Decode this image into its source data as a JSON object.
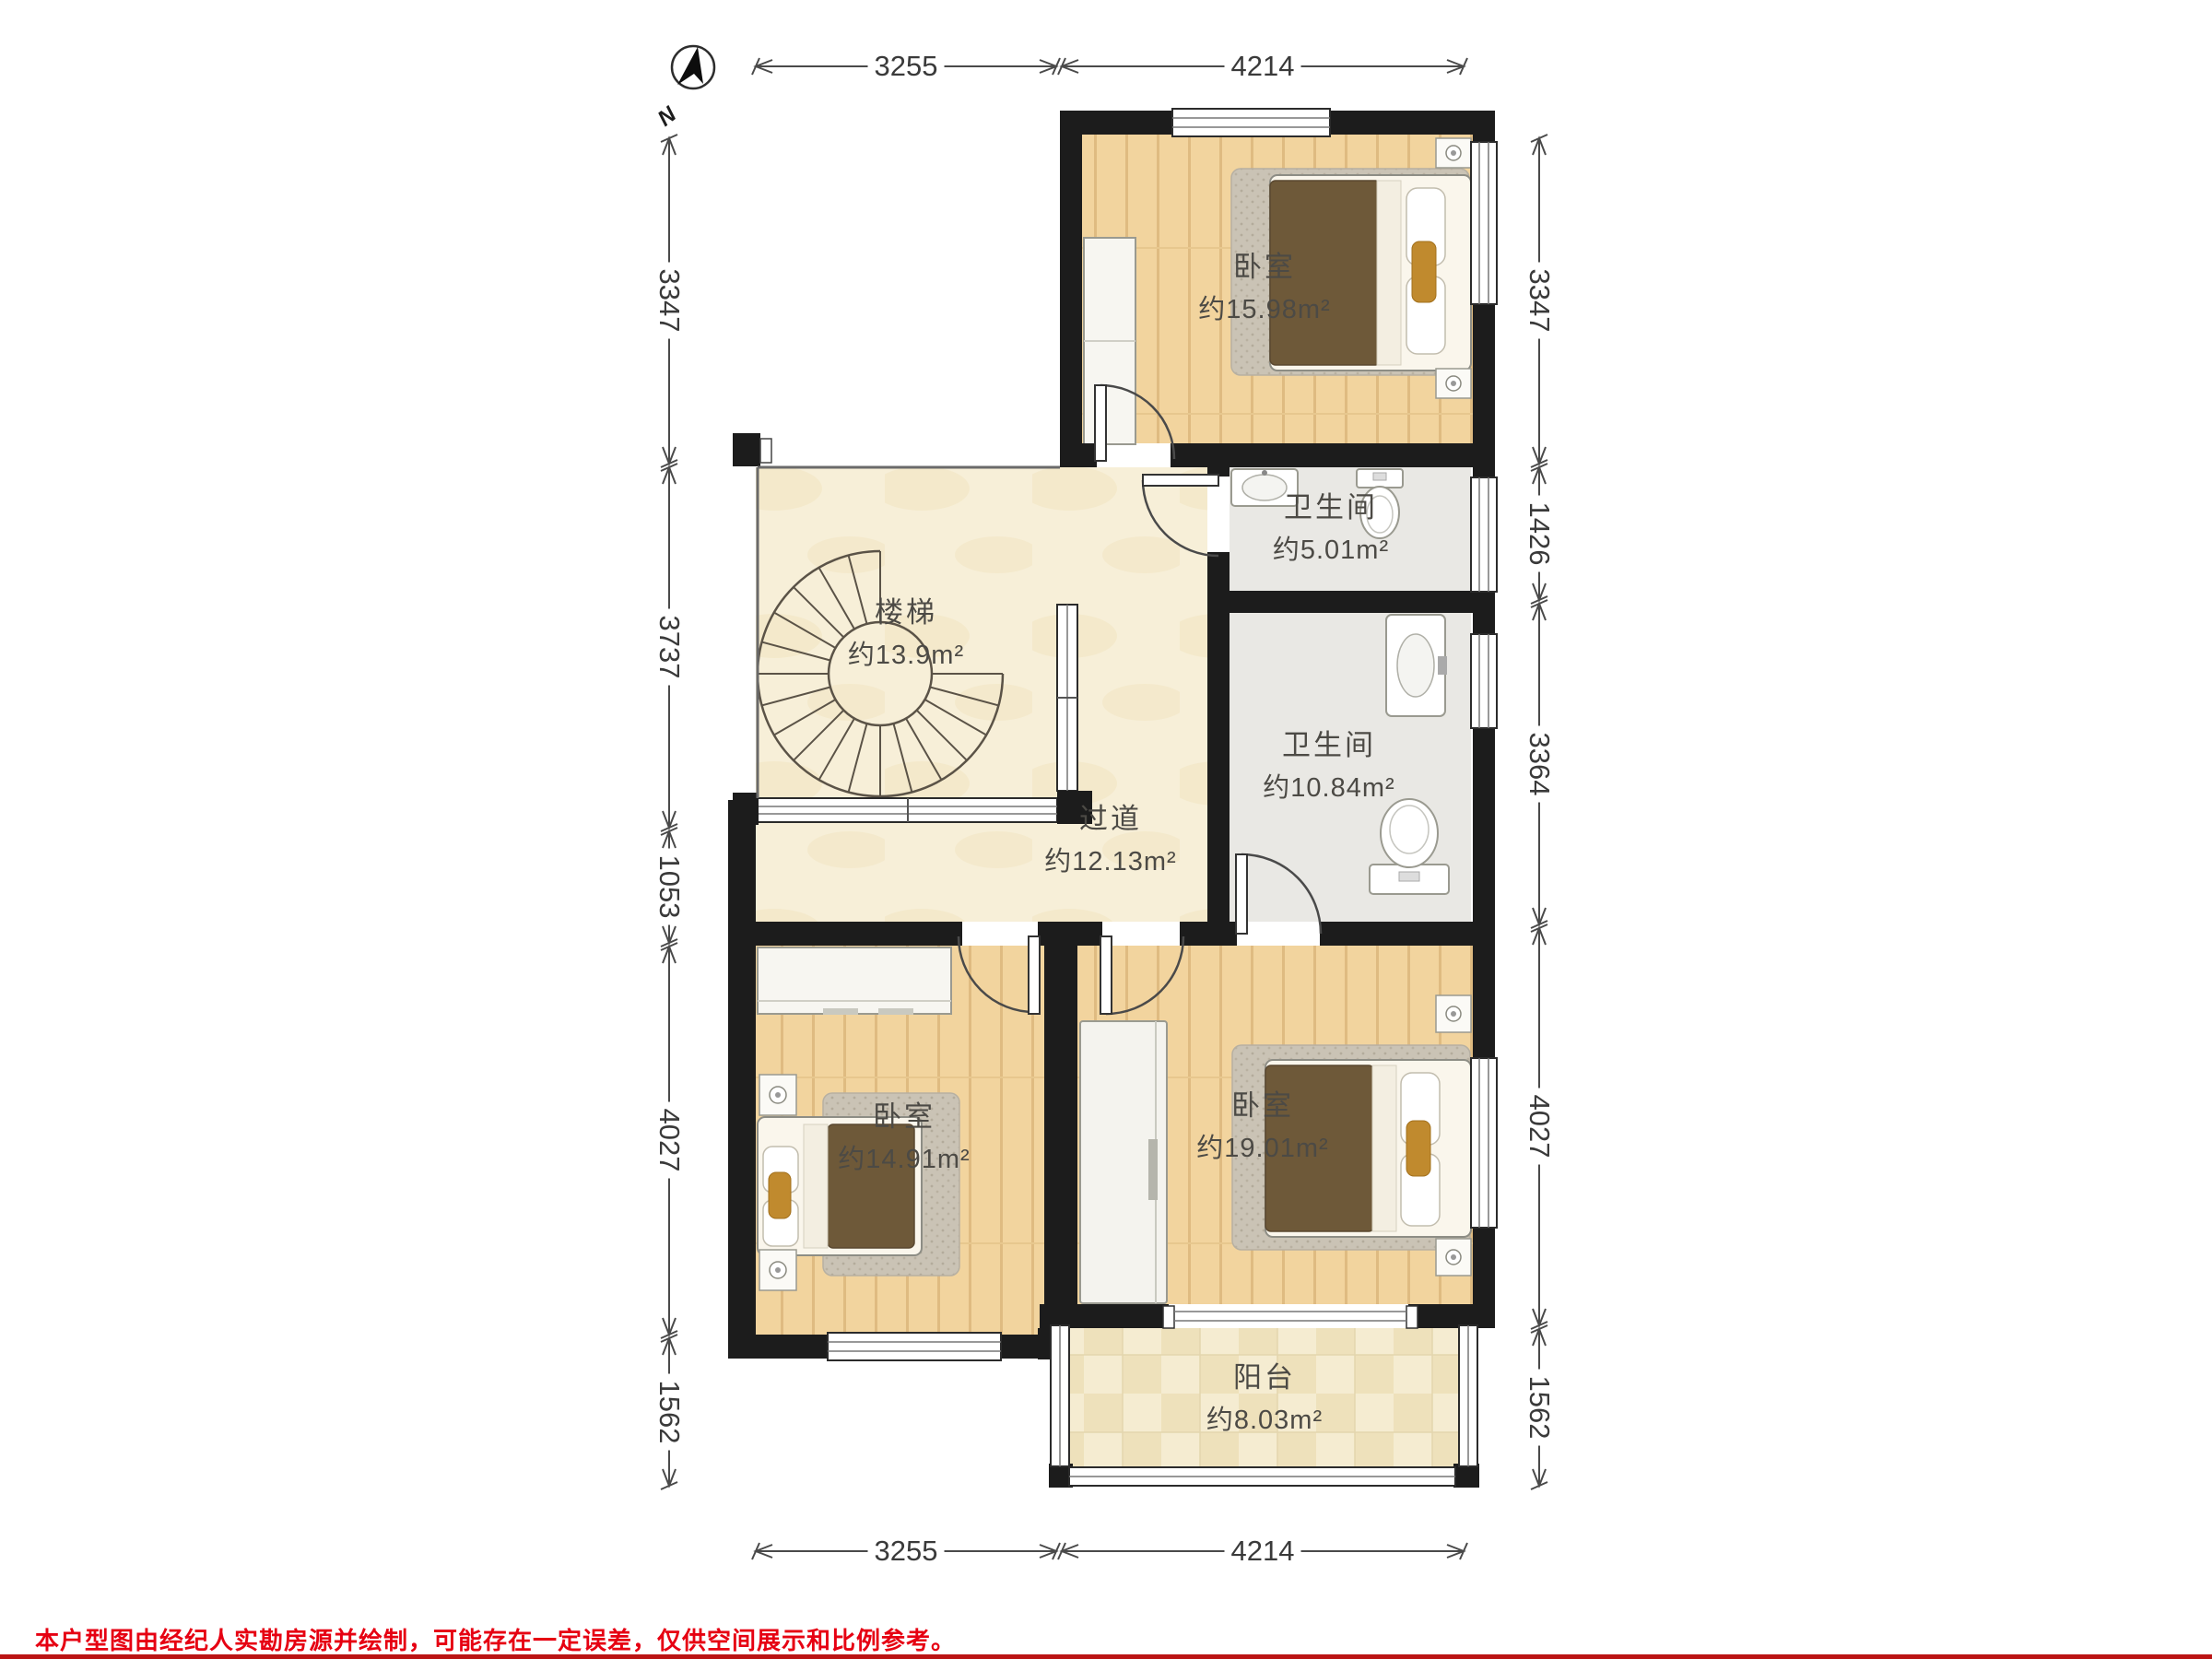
{
  "rooms": {
    "bedroom_top": {
      "name": "卧室",
      "area": "约15.98m²"
    },
    "bath_small": {
      "name": "卫生间",
      "area": "约5.01m²"
    },
    "stairs": {
      "name": "楼梯",
      "area": "约13.9m²"
    },
    "bath_large": {
      "name": "卫生间",
      "area": "约10.84m²"
    },
    "hallway": {
      "name": "过道",
      "area": "约12.13m²"
    },
    "bedroom_left": {
      "name": "卧室",
      "area": "约14.91m²"
    },
    "bedroom_right": {
      "name": "卧室",
      "area": "约19.01m²"
    },
    "balcony": {
      "name": "阳台",
      "area": "约8.03m²"
    }
  },
  "dimensions": {
    "top": [
      "3255",
      "4214"
    ],
    "bottom": [
      "3255",
      "4214"
    ],
    "left": [
      "3347",
      "3737",
      "1053",
      "4027",
      "1562"
    ],
    "right": [
      "3347",
      "1426",
      "3364",
      "4027",
      "1562"
    ]
  },
  "compass": {
    "label": "N"
  },
  "disclaimer": "本户型图由经纪人实勘房源并绘制，可能存在一定误差，仅供空间展示和比例参考。",
  "colors": {
    "wall": "#1c1c1c",
    "wood_floor": "#f2d49e",
    "marble_floor": "#f7efd8",
    "bath_floor": "#e9e8e4",
    "balcony_tile": "#f5ecd1",
    "rug": "#cac3b5",
    "duvet": "#6e5939",
    "cushion": "#c08a2e",
    "disclaimer_red": "#e60012"
  }
}
